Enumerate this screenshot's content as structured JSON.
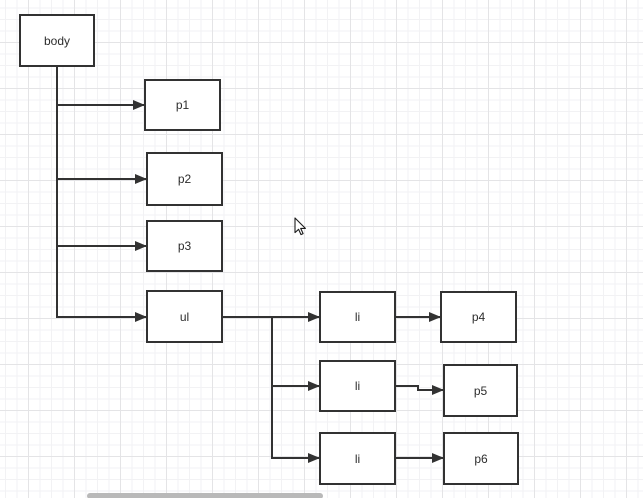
{
  "canvas": {
    "width": 643,
    "height": 498,
    "background_color": "#ffffff",
    "grid": {
      "minor_color": "#f2f2f4",
      "major_color": "#e4e4e6",
      "minor_step": 11.5,
      "major_step": 46
    }
  },
  "diagram": {
    "stroke_color": "#323232",
    "node_fill_color": "#ffffff",
    "text_color": "#2d2d2d",
    "nodes": [
      {
        "id": "body",
        "label": "body",
        "x": 19,
        "y": 14,
        "w": 76,
        "h": 53
      },
      {
        "id": "p1",
        "label": "p1",
        "x": 144,
        "y": 79,
        "w": 77,
        "h": 52
      },
      {
        "id": "p2",
        "label": "p2",
        "x": 146,
        "y": 152,
        "w": 77,
        "h": 54
      },
      {
        "id": "p3",
        "label": "p3",
        "x": 146,
        "y": 220,
        "w": 77,
        "h": 52
      },
      {
        "id": "ul",
        "label": "ul",
        "x": 146,
        "y": 290,
        "w": 77,
        "h": 53
      },
      {
        "id": "li1",
        "label": "li",
        "x": 319,
        "y": 291,
        "w": 77,
        "h": 52
      },
      {
        "id": "p4",
        "label": "p4",
        "x": 440,
        "y": 291,
        "w": 77,
        "h": 52
      },
      {
        "id": "li2",
        "label": "li",
        "x": 319,
        "y": 360,
        "w": 77,
        "h": 52
      },
      {
        "id": "p5",
        "label": "p5",
        "x": 443,
        "y": 364,
        "w": 75,
        "h": 53
      },
      {
        "id": "li3",
        "label": "li",
        "x": 319,
        "y": 432,
        "w": 77,
        "h": 53
      },
      {
        "id": "p6",
        "label": "p6",
        "x": 443,
        "y": 432,
        "w": 76,
        "h": 53
      }
    ],
    "edges": [
      {
        "from": "body",
        "to": "p1",
        "points": [
          [
            57,
            67
          ],
          [
            57,
            105
          ],
          [
            144,
            105
          ]
        ]
      },
      {
        "from": "body",
        "to": "p2",
        "points": [
          [
            57,
            67
          ],
          [
            57,
            179
          ],
          [
            146,
            179
          ]
        ]
      },
      {
        "from": "body",
        "to": "p3",
        "points": [
          [
            57,
            67
          ],
          [
            57,
            246
          ],
          [
            146,
            246
          ]
        ]
      },
      {
        "from": "body",
        "to": "ul",
        "points": [
          [
            57,
            67
          ],
          [
            57,
            317
          ],
          [
            146,
            317
          ]
        ]
      },
      {
        "from": "ul",
        "to": "li1",
        "points": [
          [
            223,
            317
          ],
          [
            319,
            317
          ]
        ]
      },
      {
        "from": "ul",
        "to": "li2",
        "points": [
          [
            223,
            317
          ],
          [
            272,
            317
          ],
          [
            272,
            386
          ],
          [
            319,
            386
          ]
        ]
      },
      {
        "from": "ul",
        "to": "li3",
        "points": [
          [
            223,
            317
          ],
          [
            272,
            317
          ],
          [
            272,
            458
          ],
          [
            319,
            458
          ]
        ]
      },
      {
        "from": "li1",
        "to": "p4",
        "points": [
          [
            396,
            317
          ],
          [
            440,
            317
          ]
        ]
      },
      {
        "from": "li2",
        "to": "p5",
        "points": [
          [
            396,
            386
          ],
          [
            418,
            386
          ],
          [
            418,
            390
          ],
          [
            443,
            390
          ]
        ]
      },
      {
        "from": "li3",
        "to": "p6",
        "points": [
          [
            396,
            458
          ],
          [
            443,
            458
          ]
        ]
      }
    ]
  },
  "cursor": {
    "x": 294,
    "y": 217
  },
  "scrollbar": {
    "x": 87,
    "y": 493,
    "width": 236,
    "height": 6,
    "color": "#b9b9b9"
  }
}
